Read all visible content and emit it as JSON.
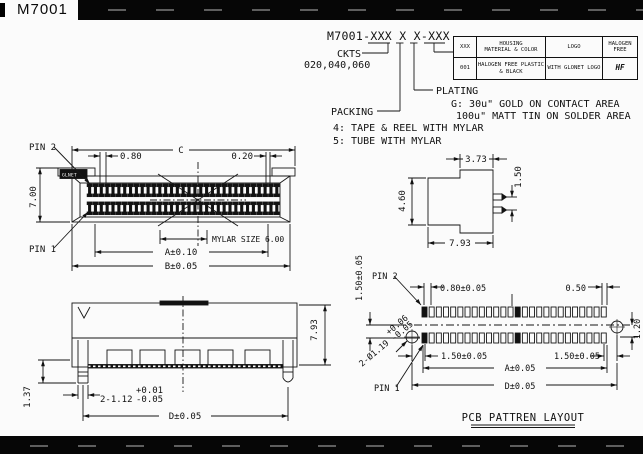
{
  "header": {
    "part": "M7001"
  },
  "ordering": {
    "code": "M7001-XXX X X-XXX",
    "ckts": "CKTS",
    "ckts_values": "020,040,060",
    "plating": "PLATING",
    "plating_g": "G: 30u\" GOLD ON CONTACT AREA",
    "plating_tin": "100u\" MATT TIN ON SOLDER AREA",
    "packing": "PACKING",
    "packing_4": "4: TAPE & REEL WITH MYLAR",
    "packing_5": "5: TUBE WITH MYLAR"
  },
  "spec_table": {
    "col_xxx": "XXX",
    "col_housing_1": "HOUSING",
    "col_housing_2": "MATERIAL & COLOR",
    "col_logo": "LOGO",
    "col_hf_1": "HALOGEN",
    "col_hf_2": "FREE",
    "row_code": "001",
    "row_housing_1": "HALOGEN FREE PLASTIC",
    "row_housing_2": "& BLACK",
    "row_logo": "WITH GLONET LOGO",
    "row_hf": "HF"
  },
  "top_view": {
    "pin2": "PIN 2",
    "pin1": "PIN 1",
    "dim_c": "C",
    "dim_080": "0.80",
    "dim_020": "0.20",
    "dim_700": "7.00",
    "mylar": "MYLAR SIZE 6.00",
    "dim_a": "A±0.10",
    "dim_b": "B±0.05",
    "logo": "GLNET"
  },
  "side_view": {
    "dim_373": "3.73",
    "dim_460": "4.60",
    "dim_150": "1.50",
    "dim_793": "7.93"
  },
  "front_view": {
    "dim_793": "7.93",
    "dim_137": "1.37",
    "peg": "2-1.12",
    "peg_tol_plus": "+0.01",
    "peg_tol_minus": "-0.05",
    "dim_d": "D±0.05"
  },
  "pcb": {
    "pin2": "PIN 2",
    "pin1": "PIN 1",
    "dim_150_vert": "1.50±0.05",
    "dim_080": "0.80±0.05",
    "dim_050": "0.50",
    "dim_120": "1.20",
    "dim_150_left": "1.50±0.05",
    "dim_150_right": "1.50±0.05",
    "hole": "2-Ø1.19",
    "hole_tol_plus": "+0.06",
    "hole_tol_minus": "-0.05",
    "dim_a": "A±0.05",
    "dim_d": "D±0.05",
    "title": "PCB PATTREN LAYOUT"
  }
}
